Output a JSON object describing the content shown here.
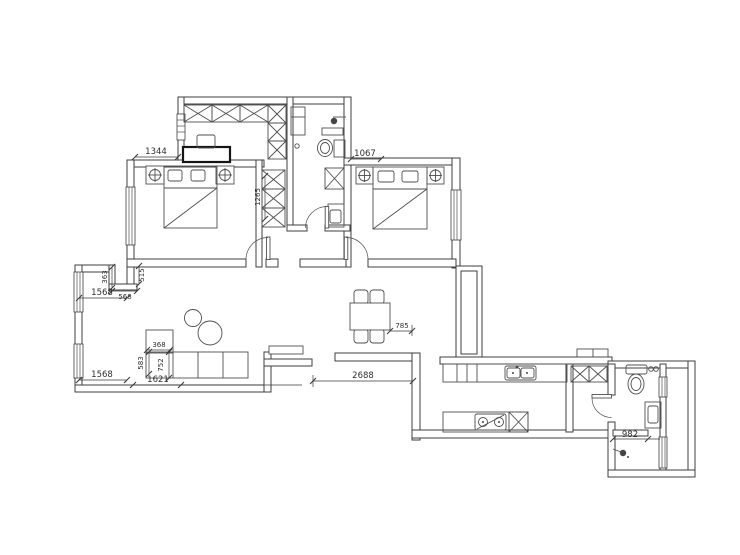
{
  "drawing": {
    "type": "floor-plan",
    "background": "#ffffff",
    "wall_color": "#3f3f3f",
    "furniture_color": "#4f4f4f",
    "dimension_color": "#2e2e2e",
    "unit": "mm"
  },
  "dims": {
    "bed1_top": "1344",
    "bed2_top": "1067",
    "closet_col": "1265",
    "step_a": "363",
    "step_b": "515",
    "step_c": "568",
    "nook_width": "1568",
    "chaise_width": "368",
    "sofa_side_a": "583",
    "sofa_side_b": "752",
    "west_window": "1568",
    "sofa_length": "1621",
    "table_side": "785",
    "hall_span": "2688",
    "bath_span": "982"
  },
  "symbols": {
    "wardrobe": "crossed-box-grid",
    "bed": "rect-with-pillows-and-diagonal",
    "lamp": "circle-with-cross",
    "toilet": "tank-and-bowl",
    "shower": "head-with-arm",
    "kitchen_sink": "double-basin",
    "stove": "two-burner-hob",
    "sofa": "l-shaped-sections",
    "dining_table": "table-with-four-chairs",
    "door": "quarter-circle-arc"
  }
}
